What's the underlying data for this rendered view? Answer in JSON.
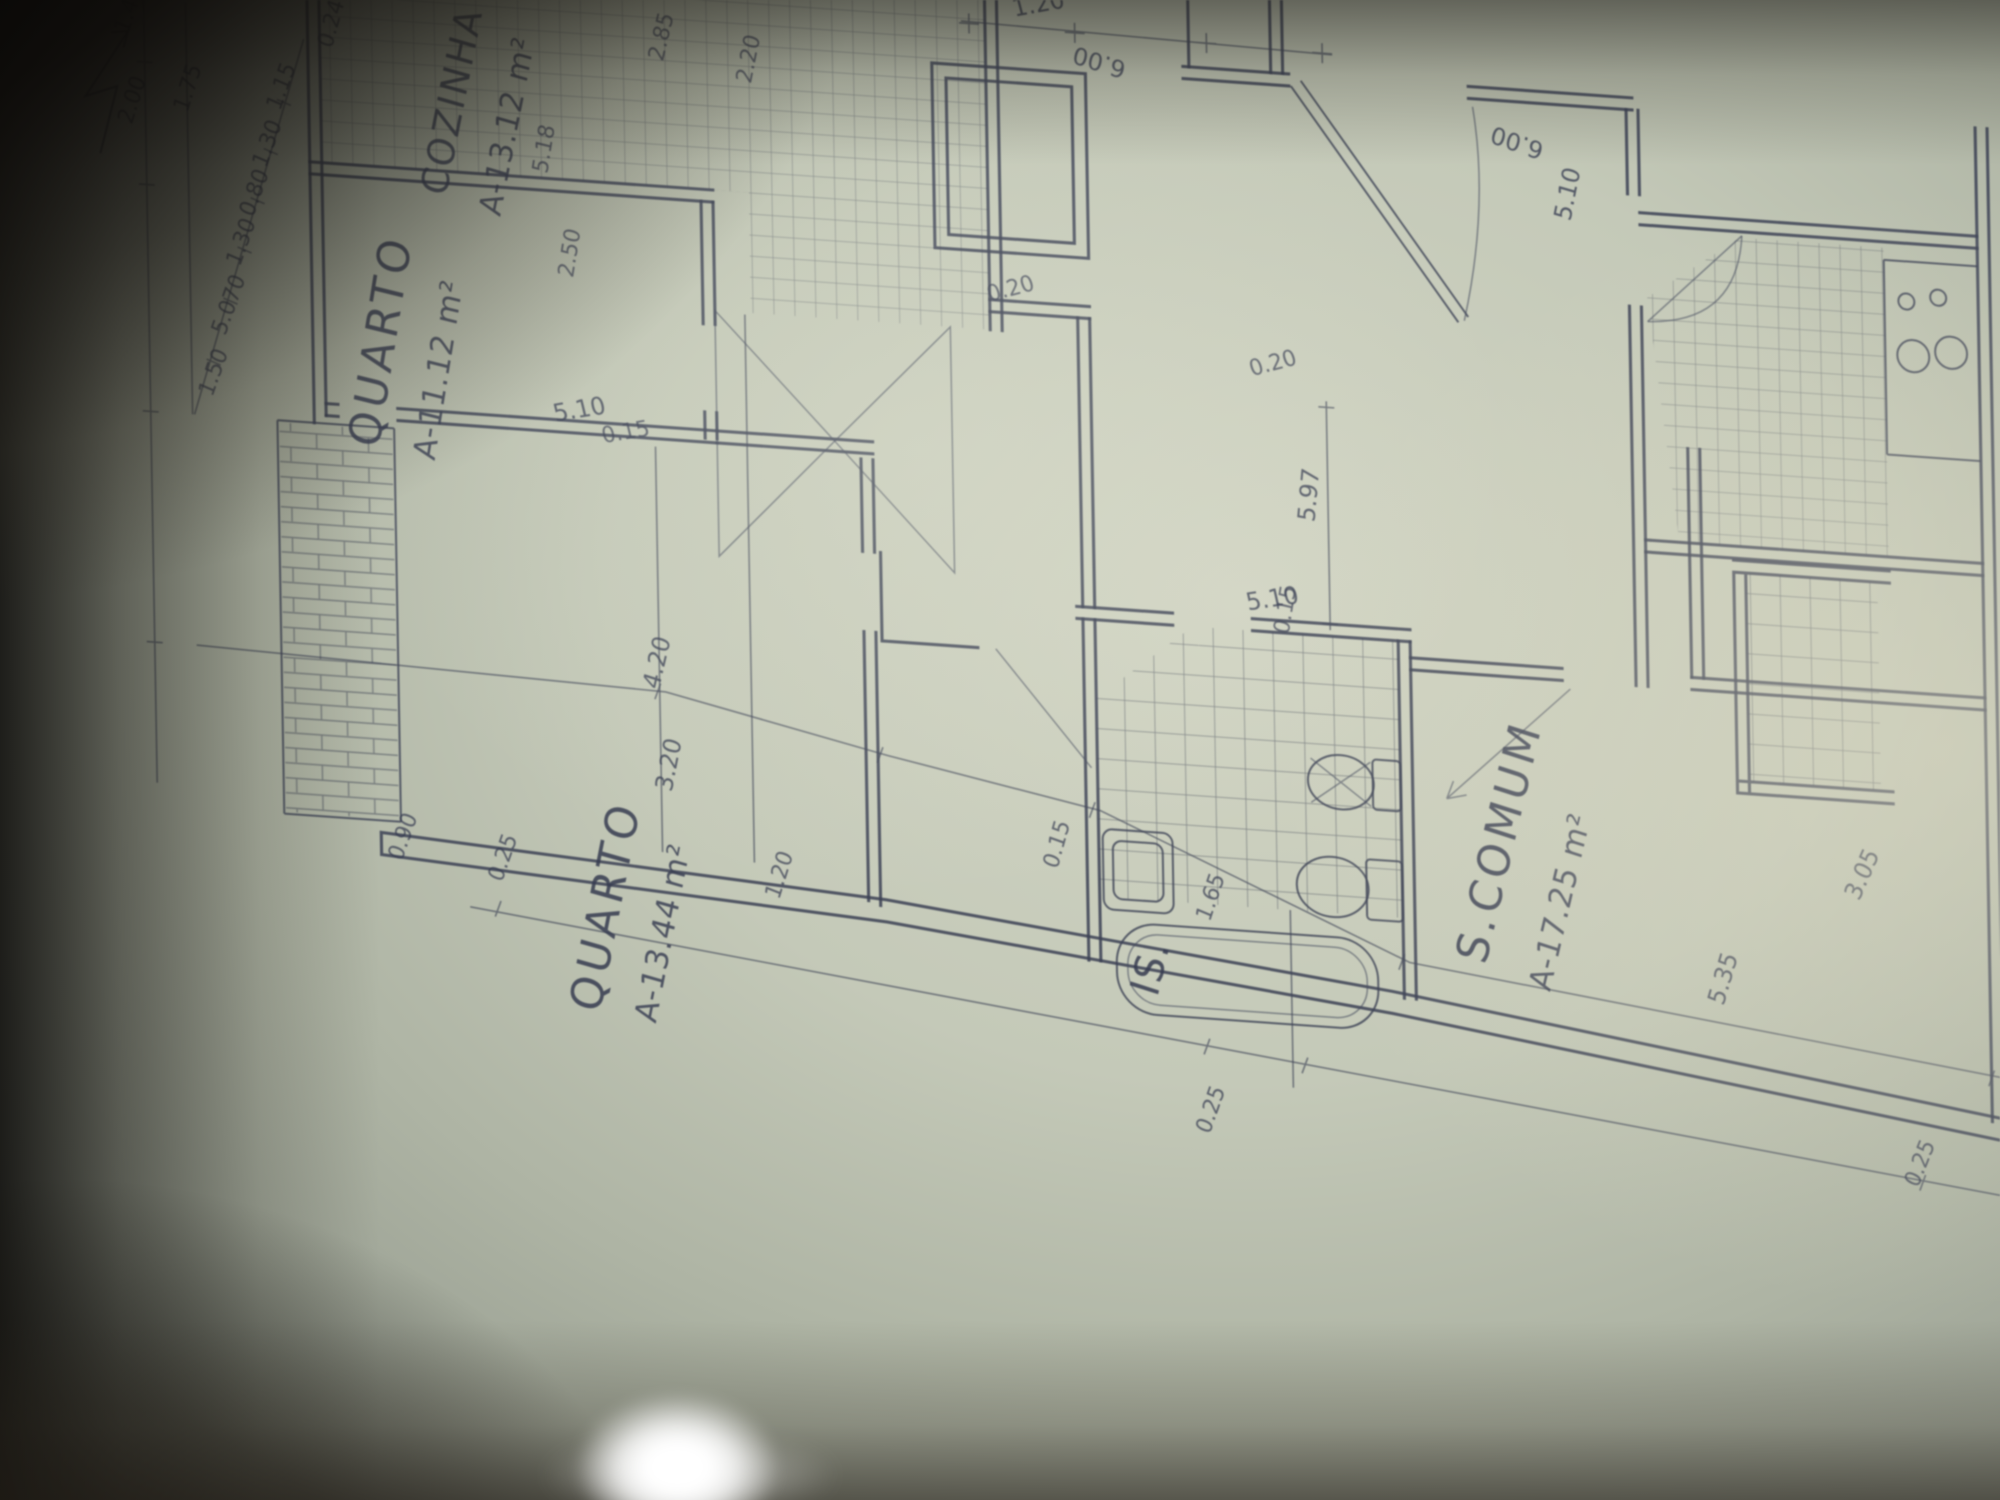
{
  "photo": {
    "ink_color": "#3b4156",
    "paper_color": "#c4c9b8",
    "shadow_color": "#14120e",
    "glare_color": "#ffffff"
  },
  "rooms": {
    "cozinha": {
      "name": "COZINHA",
      "area": "A-13.12 m²"
    },
    "quarto1": {
      "name": "QUARTO",
      "area": "A-11.12 m²"
    },
    "quarto2": {
      "name": "QUARTO",
      "area": "A-13.44 m²"
    },
    "scomum": {
      "name": "S.COMUM",
      "area": "A-17.25 m²"
    },
    "is_bath": {
      "name": "IS."
    }
  },
  "icons": {
    "north_arrow": "north-arrow",
    "fixtures": [
      "sink",
      "toilet",
      "bidet",
      "bathtub",
      "stove-burners"
    ]
  },
  "dims": [
    {
      "t": "1.40"
    },
    {
      "t": "2.00"
    },
    {
      "t": "1.75"
    },
    {
      "t": "1.50"
    },
    {
      "t": "5.070"
    },
    {
      "t": "1.30"
    },
    {
      "t": "0.80"
    },
    {
      "t": "1.30"
    },
    {
      "t": "1.15"
    },
    {
      "t": "0.24"
    },
    {
      "t": "2.85"
    },
    {
      "t": "2.20"
    },
    {
      "t": "1.20"
    },
    {
      "t": "6.00"
    },
    {
      "t": "6.00"
    },
    {
      "t": "5.10"
    },
    {
      "t": "0.20"
    },
    {
      "t": "0.20"
    },
    {
      "t": "5.18"
    },
    {
      "t": "2.50"
    },
    {
      "t": "5.10"
    },
    {
      "t": "0.15"
    },
    {
      "t": "5.10"
    },
    {
      "t": "0.15"
    },
    {
      "t": "5.97"
    },
    {
      "t": "0.90"
    },
    {
      "t": "4.20"
    },
    {
      "t": "3.20"
    },
    {
      "t": "1.20"
    },
    {
      "t": "0.15"
    },
    {
      "t": "1.65"
    },
    {
      "t": "3.05"
    },
    {
      "t": "5.35"
    },
    {
      "t": "0.25"
    },
    {
      "t": "0.25"
    },
    {
      "t": "0.25"
    }
  ]
}
